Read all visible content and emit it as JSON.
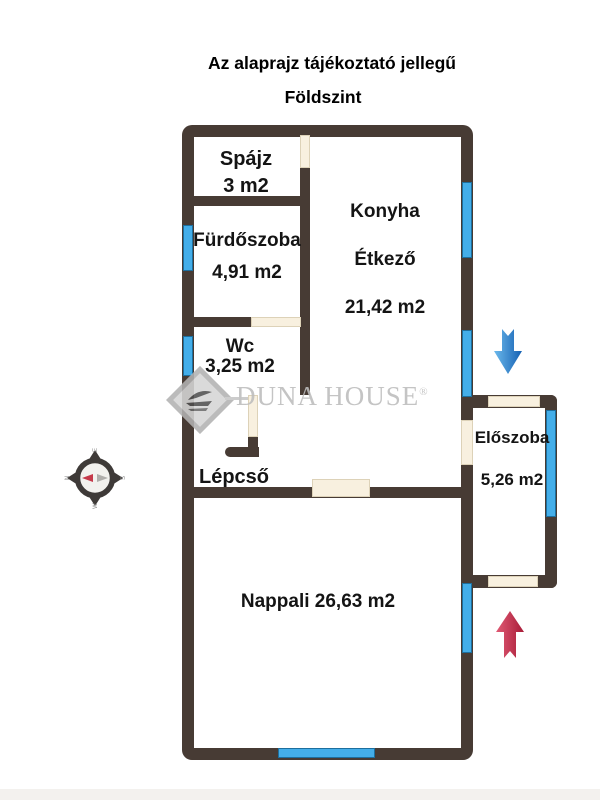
{
  "header": {
    "line1": "Az alaprajz tájékoztató jellegű",
    "line2": "Földszint"
  },
  "rooms": {
    "spajz": {
      "name": "Spájz",
      "area": "3 m2"
    },
    "furdoszoba": {
      "name": "Fürdőszoba",
      "area": "4,91 m2"
    },
    "konyha": {
      "name": "Konyha",
      "name2": "Étkező",
      "area": "21,42 m2"
    },
    "wc": {
      "name": "Wc",
      "area": "3,25 m2"
    },
    "lepcso": {
      "name": "Lépcső"
    },
    "nappali": {
      "label": "Nappali 26,63 m2"
    },
    "eloszoba": {
      "name": "Előszoba",
      "area": "5,26 m2"
    }
  },
  "watermark": {
    "brand": "DUNA HOUSE",
    "registered": "®"
  },
  "compass": {
    "left": "N",
    "top": "E",
    "right": "S",
    "bottom": "W"
  },
  "icons": {
    "compass": "compass-rose",
    "entry_arrow_down": "blue-down-arrow",
    "entry_arrow_up": "red-up-arrow",
    "logo": "duna-house-diamond"
  },
  "colors": {
    "wall": "#473b34",
    "window": "#44aee9",
    "window-border": "#1d6f9e",
    "door": "#f8f0df",
    "door-border": "#ddd2b8",
    "text": "#141414",
    "watermark": "#bdbdbd",
    "arrow-blue": "#2e86d3",
    "arrow-red": "#c6284a"
  }
}
